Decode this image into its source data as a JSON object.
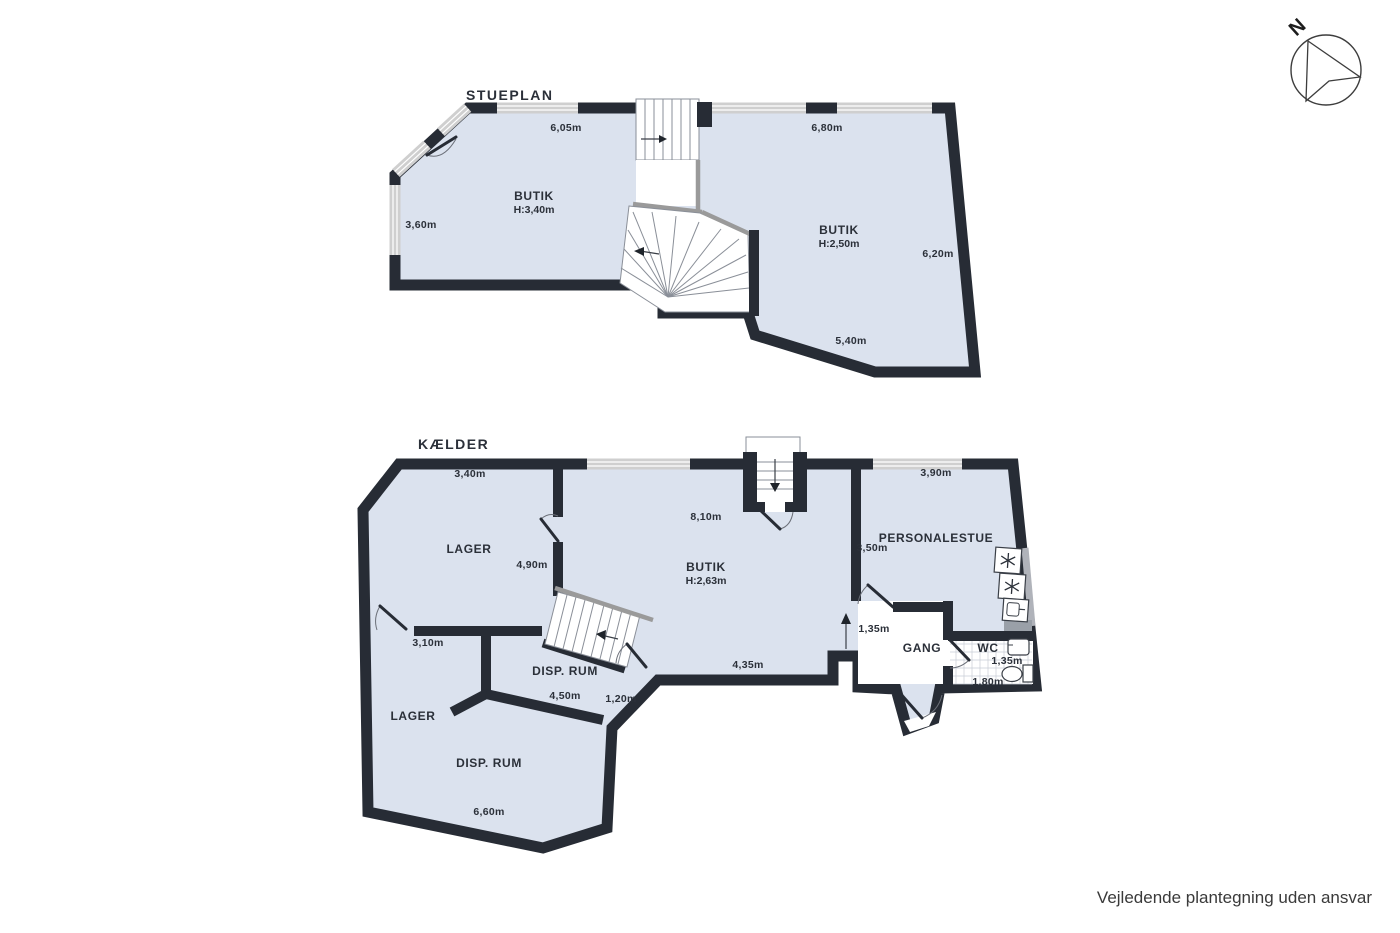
{
  "colors": {
    "floor": "#dbe2ee",
    "wall": "#272c35",
    "stair_rail": "#9a9a9a",
    "window": "#cfcfcf"
  },
  "compass": {
    "label": "N"
  },
  "footer": {
    "disclaimer": "Vejledende plantegning uden ansvar"
  },
  "stueplan": {
    "title": "STUEPLAN",
    "rooms": {
      "butik_left": {
        "name": "BUTIK",
        "height": "H:3,40m"
      },
      "butik_right": {
        "name": "BUTIK",
        "height": "H:2,50m"
      }
    },
    "dims": {
      "top_left": "6,05m",
      "top_right": "6,80m",
      "left": "3,60m",
      "right": "6,20m",
      "bottom": "5,40m"
    }
  },
  "kaelder": {
    "title": "KÆLDER",
    "rooms": {
      "lager_top": {
        "name": "LAGER"
      },
      "butik": {
        "name": "BUTIK",
        "height": "H:2,63m"
      },
      "personalestue": {
        "name": "PERSONALESTUE"
      },
      "gang": {
        "name": "GANG"
      },
      "wc": {
        "name": "WC"
      },
      "disp_rum_top": {
        "name": "DISP. RUM"
      },
      "lager_bottom": {
        "name": "LAGER"
      },
      "disp_rum_bottom": {
        "name": "DISP. RUM"
      }
    },
    "dims": {
      "top_left": "3,40m",
      "top_mid": "8,10m",
      "top_right": "3,90m",
      "lager_right": "4,90m",
      "pers_left": "3,50m",
      "lager_bottom": "3,10m",
      "passage": "1,35m",
      "butik_bottom": "4,35m",
      "disp_top": "4,50m",
      "disp_edge": "1,20m",
      "wc_width": "1,35m",
      "wc_height": "1,80m",
      "disp_bottom": "6,60m"
    }
  }
}
